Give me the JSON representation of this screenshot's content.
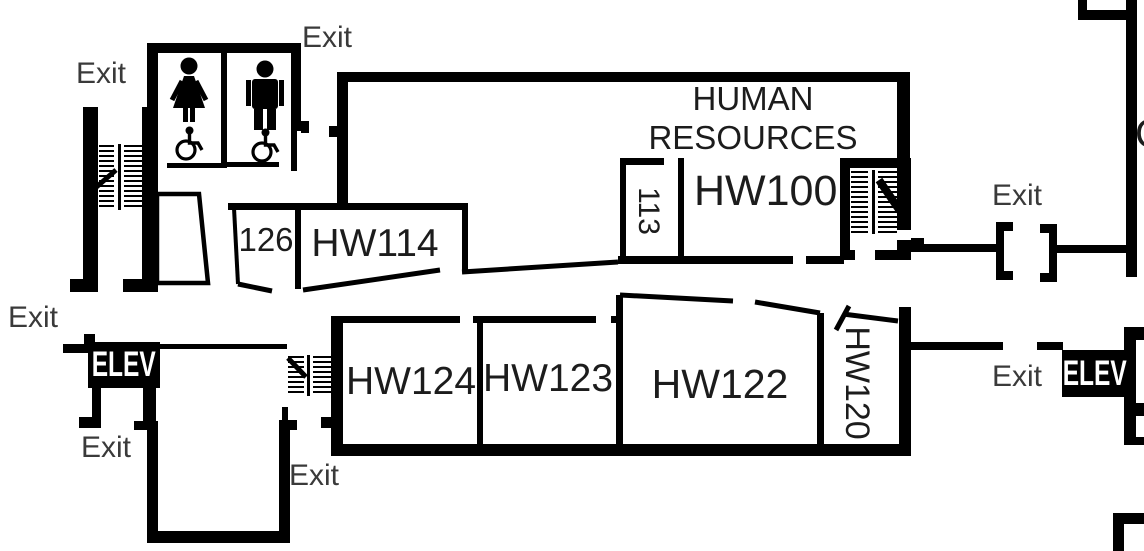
{
  "labels": {
    "department": "HUMAN RESOURCES",
    "rooms": {
      "hw100": "HW100",
      "r113": "113",
      "r126": "126",
      "hw114": "HW114",
      "hw124": "HW124",
      "hw123": "HW123",
      "hw122": "HW122",
      "hw120": "HW120"
    },
    "exit": {
      "top_left": "Exit",
      "restrooms_top": "Exit",
      "upper_right": "Exit",
      "left_corridor": "Exit",
      "lower_left": "Exit",
      "bottom_center": "Exit",
      "lower_right": "Exit"
    },
    "elevator_left": "ELEV",
    "elevator_right": "ELEV",
    "partial_label_right_edge": "C"
  },
  "icons": {
    "restroom_female": "female-figure-icon",
    "restroom_male": "male-figure-icon",
    "wheelchair_accessible": "wheelchair-icon",
    "stairs": "stairs-hatch-icon",
    "door": "door-bracket-icon"
  },
  "colors": {
    "wall": "#000000",
    "room_text": "#1c1c1c",
    "exit_text": "#3a3a3a",
    "elev_bg": "#000000",
    "elev_text": "#ffffff",
    "background": "#ffffff"
  }
}
